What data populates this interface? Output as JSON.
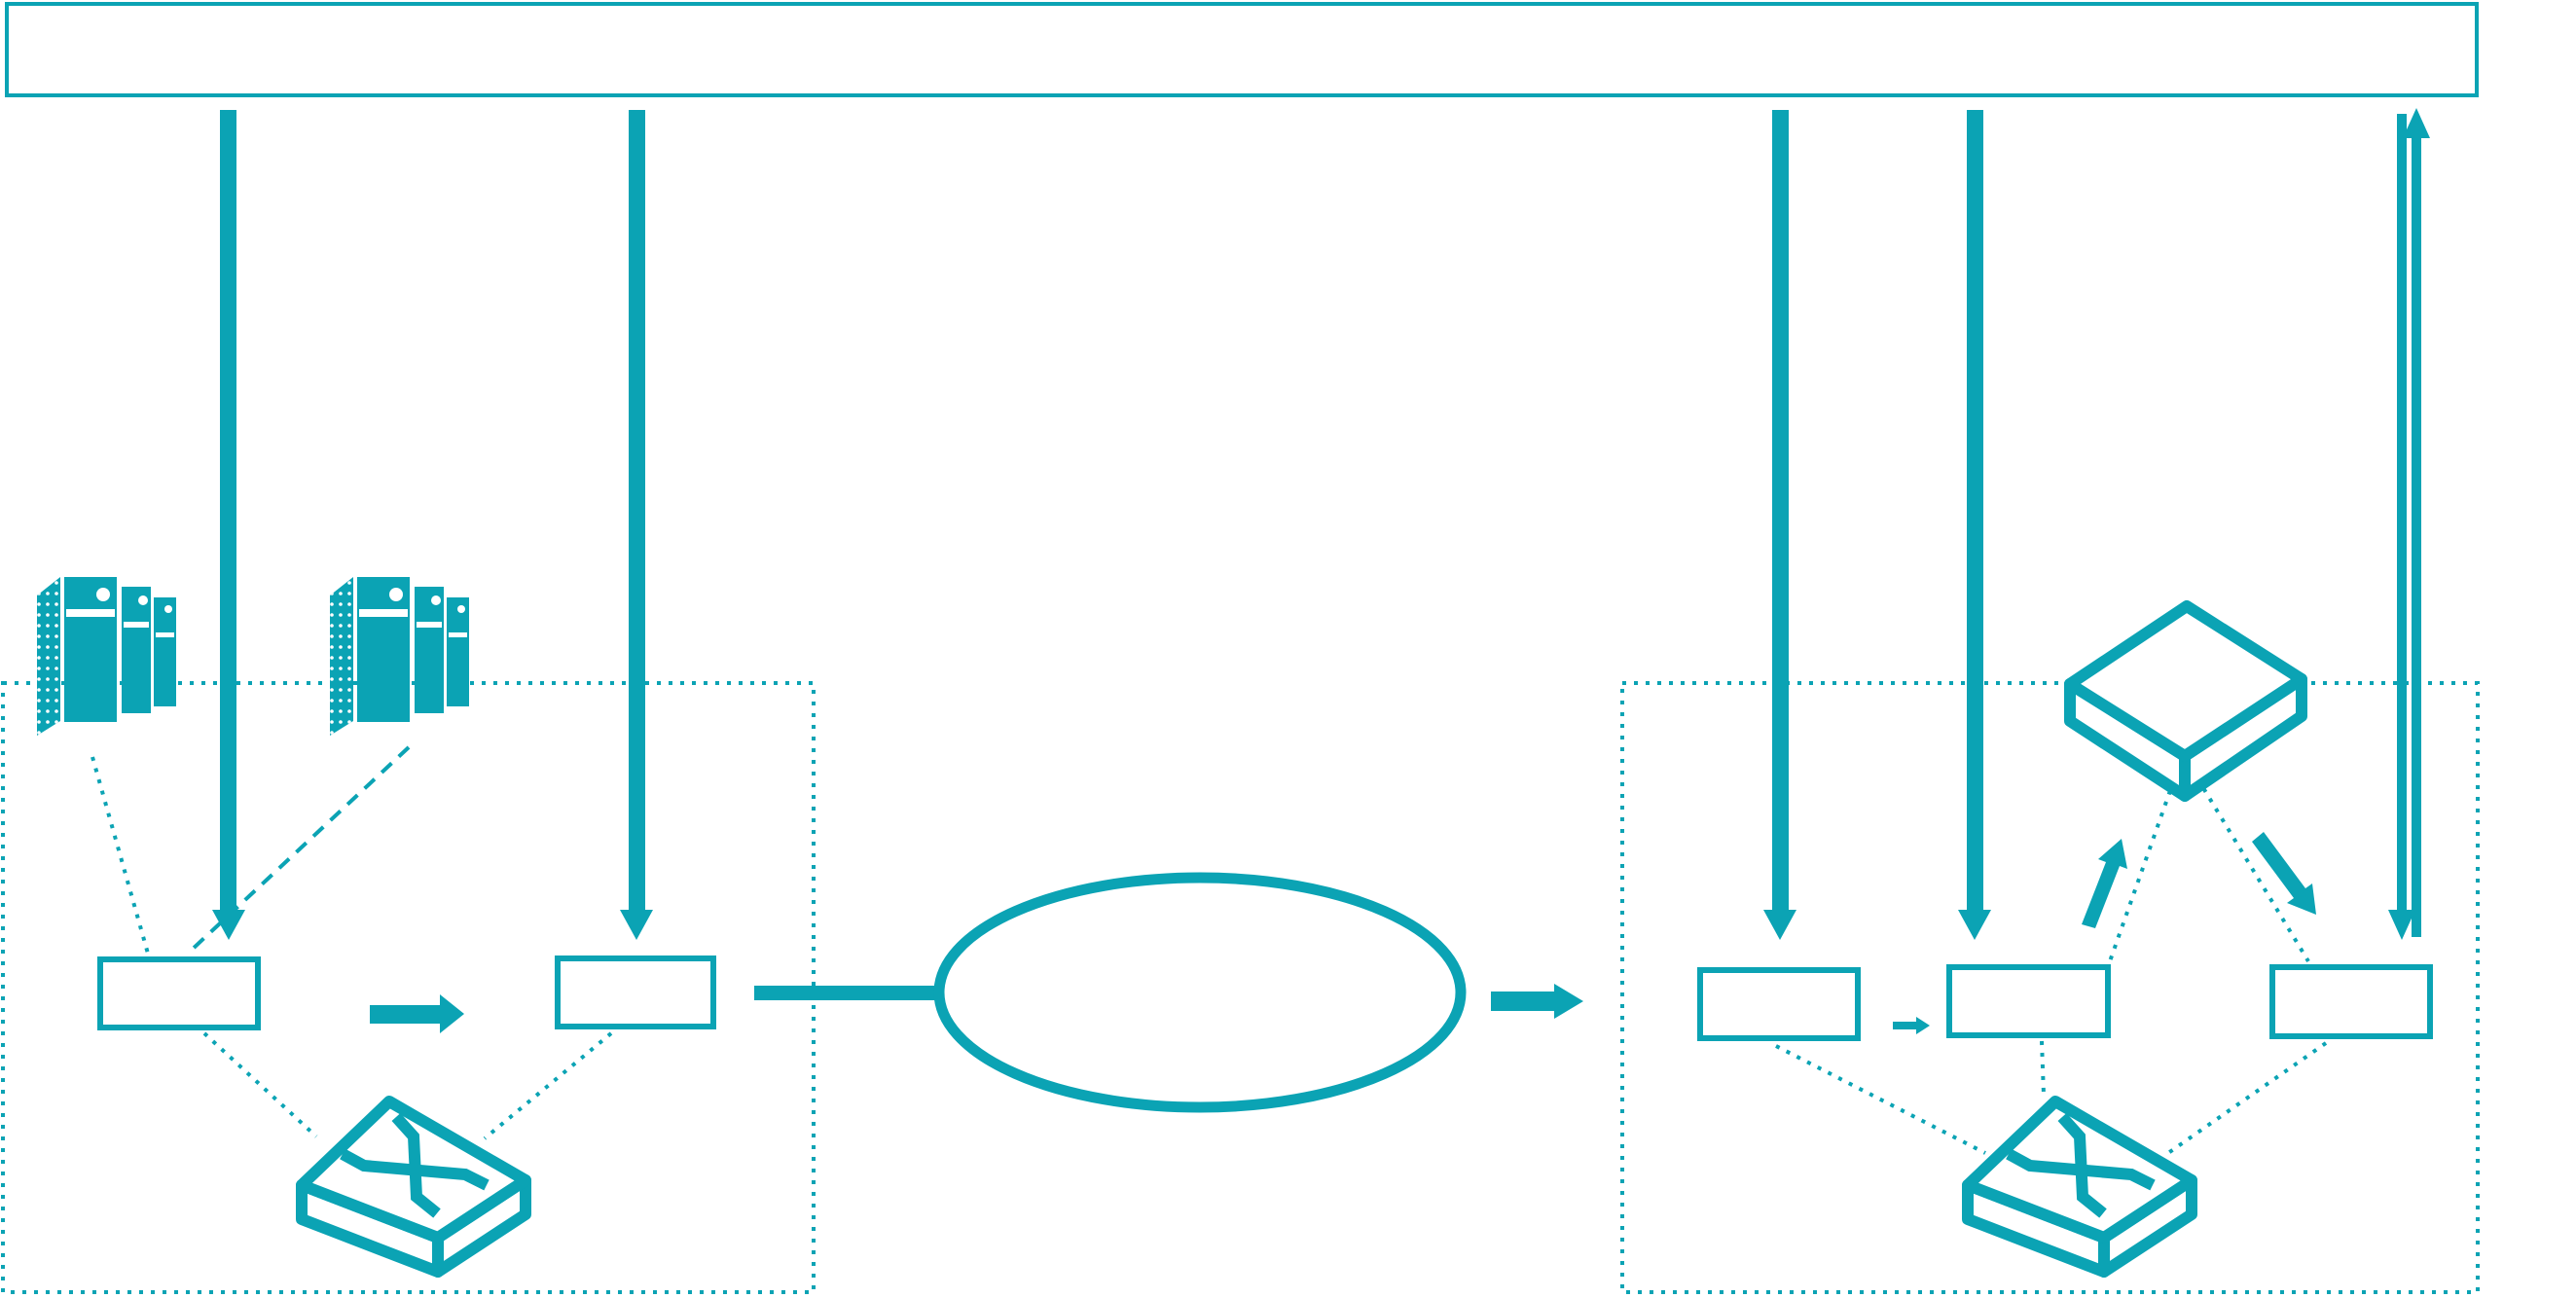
{
  "theme": {
    "accent_color": "#0ba3b4",
    "background_color": "#ffffff"
  },
  "banner": {
    "label": ""
  },
  "diagram": {
    "type": "network-architecture",
    "left_cluster": {
      "container": "dotted-rectangle",
      "server_stacks": 2,
      "node_boxes": [
        {
          "label": ""
        },
        {
          "label": ""
        }
      ],
      "switch_icon": "crossbar-switch",
      "flow": "node-box-1 -> node-box-2 -> cloud"
    },
    "cloud": {
      "shape": "ellipse",
      "label": ""
    },
    "right_cluster": {
      "container": "dotted-rectangle",
      "node_boxes": [
        {
          "label": ""
        },
        {
          "label": ""
        },
        {
          "label": ""
        }
      ],
      "switch_icon": "crossbar-switch",
      "bridge_icon": "flat-3d-box",
      "flow": "cloud -> node-box-1 -> node-box-2 -> bridge -> node-box-3 -> banner"
    },
    "arrows": {
      "banner_down_arrows": 4,
      "updown_pair_to_banner": 1,
      "block_arrows": 2,
      "small_arrow": 1,
      "bridge_up_arrow": 1,
      "bridge_down_arrow": 1
    }
  }
}
